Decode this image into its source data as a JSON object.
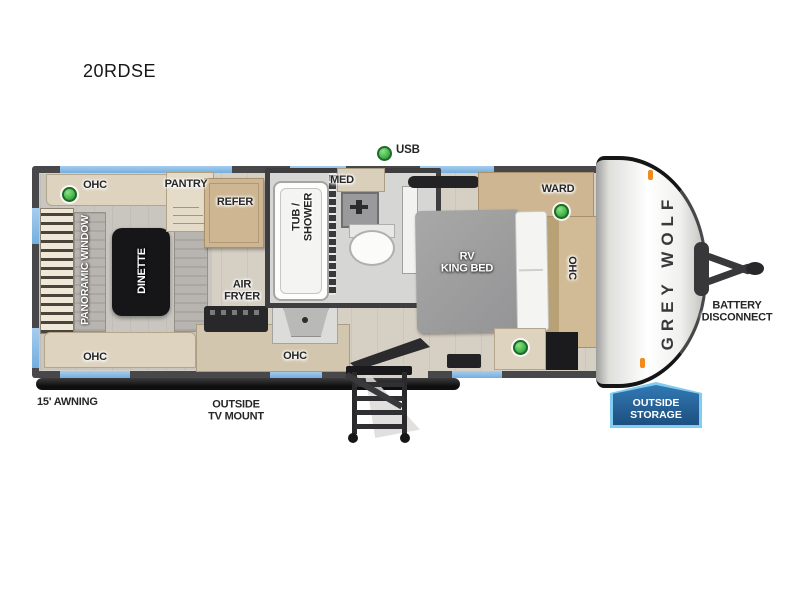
{
  "title": "20RDSE",
  "exterior": {
    "usb_label": "USB",
    "awning_label": "15' AWNING",
    "tv_mount_line1": "OUTSIDE",
    "tv_mount_line2": "TV MOUNT",
    "battery_line1": "BATTERY",
    "battery_line2": "DISCONNECT",
    "storage_line1": "OUTSIDE",
    "storage_line2": "STORAGE",
    "brand": "GREY WOLF"
  },
  "rooms": {
    "dinette": {
      "ohc_top": "OHC",
      "panoramic_window": "PANORAMIC WINDOW",
      "table": "DINETTE",
      "ohc_bottom": "OHC"
    },
    "kitchen": {
      "pantry": "PANTRY",
      "refer": "REFER",
      "air_fryer_line1": "AIR",
      "air_fryer_line2": "FRYER",
      "ohc": "OHC"
    },
    "bathroom": {
      "tub_line1": "TUB /",
      "tub_line2": "SHOWER",
      "med": "MED"
    },
    "bedroom": {
      "ward": "WARD",
      "bed_line1": "RV",
      "bed_line2": "KING BED",
      "ohc": "OHC"
    }
  },
  "colors": {
    "window_blue": "#74aede",
    "led_green": "#44b649",
    "badge_fill": "#1d4f80",
    "wall": "#48484b"
  }
}
